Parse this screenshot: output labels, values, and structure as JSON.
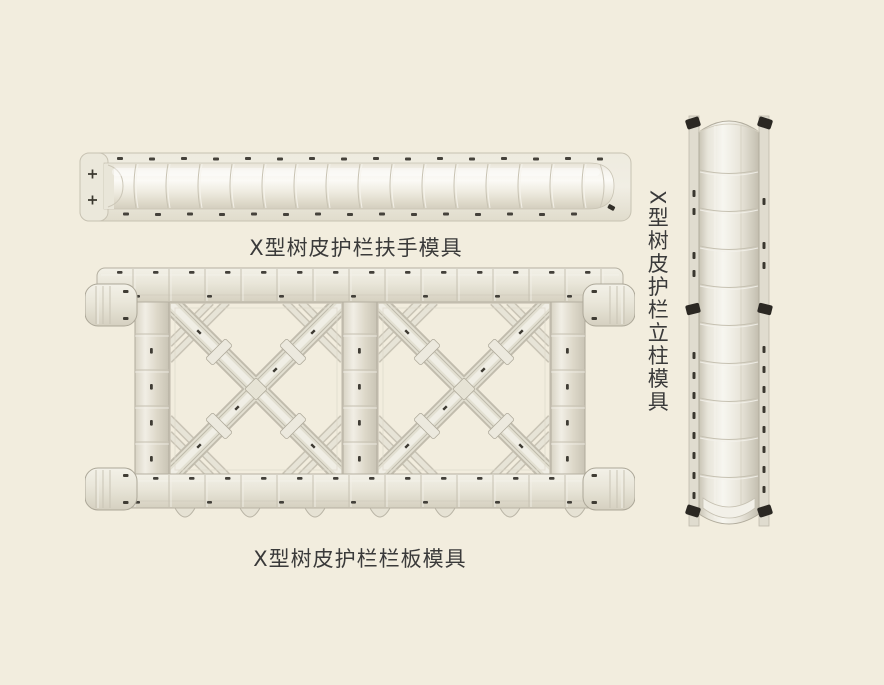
{
  "page": {
    "background_color": "#F2EDDE"
  },
  "products": [
    {
      "name": "handrail-mold",
      "caption": "X型树皮护栏扶手模具"
    },
    {
      "name": "panel-mold",
      "caption": "X型树皮护栏栏板模具"
    },
    {
      "name": "column-mold",
      "caption": "X型树皮护栏立柱模具"
    }
  ],
  "colors": {
    "mold_body": "#E9E6DA",
    "mold_highlight": "#F7F5EF",
    "mold_shadow": "#CBC6B7",
    "bolt_dark": "#3E3B33",
    "clip_black": "#2B2823",
    "caption_text": "#3A3A3A"
  }
}
